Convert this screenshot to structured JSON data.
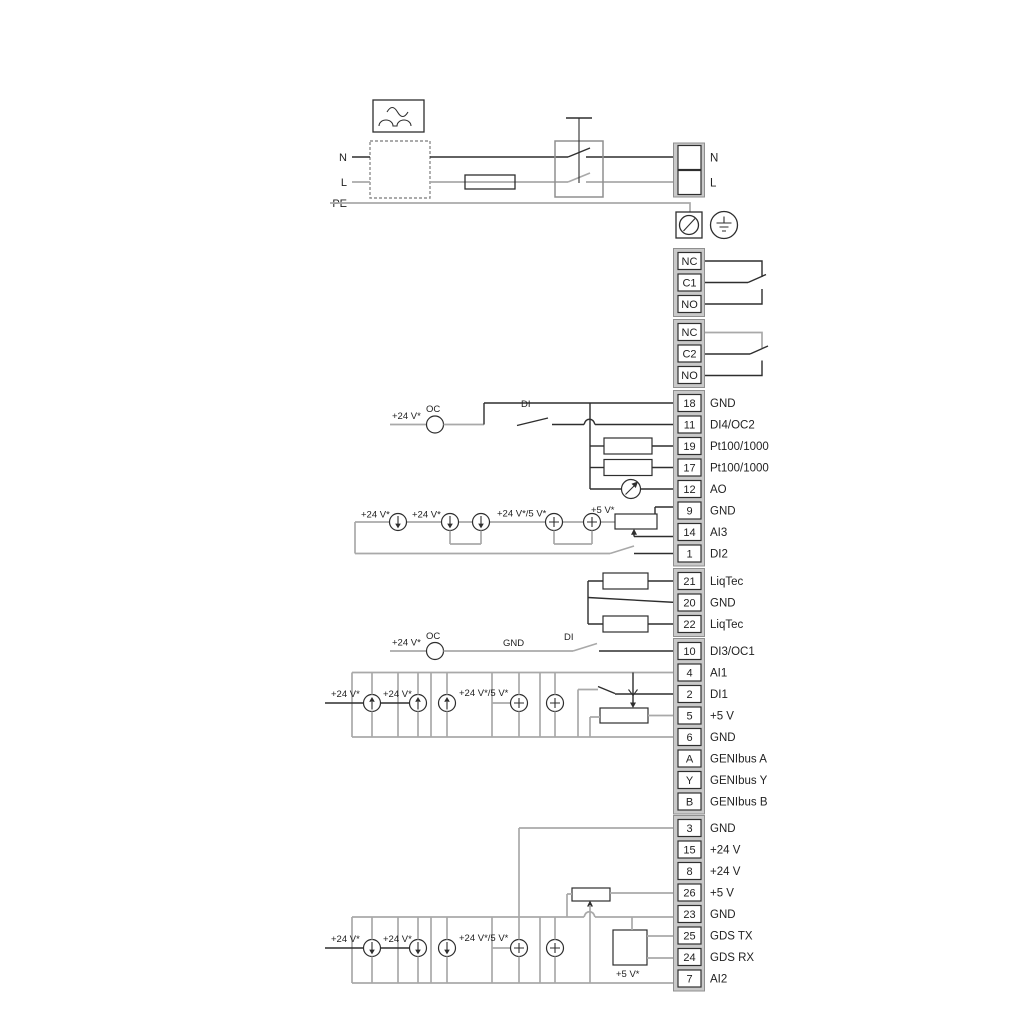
{
  "labels": {
    "n": "N",
    "l": "L",
    "pe": "PE",
    "v24": "+24 V*",
    "v24_5": "+24 V*/5 V*",
    "v5": "+5 V*",
    "oc": "OC",
    "di": "DI",
    "gnd": "GND"
  },
  "mains_block": {
    "n": "N",
    "l": "L"
  },
  "terminal_blocks": [
    {
      "name": "relay-1",
      "terminals": [
        {
          "id": "NC",
          "label": ""
        },
        {
          "id": "C1",
          "label": ""
        },
        {
          "id": "NO",
          "label": ""
        }
      ]
    },
    {
      "name": "relay-2",
      "terminals": [
        {
          "id": "NC",
          "label": ""
        },
        {
          "id": "C2",
          "label": ""
        },
        {
          "id": "NO",
          "label": ""
        }
      ]
    },
    {
      "name": "io-block-1",
      "terminals": [
        {
          "id": "18",
          "label": "GND"
        },
        {
          "id": "11",
          "label": "DI4/OC2"
        },
        {
          "id": "19",
          "label": "Pt100/1000"
        },
        {
          "id": "17",
          "label": "Pt100/1000"
        },
        {
          "id": "12",
          "label": "AO"
        },
        {
          "id": "9",
          "label": "GND"
        },
        {
          "id": "14",
          "label": "AI3"
        },
        {
          "id": "1",
          "label": "DI2"
        }
      ]
    },
    {
      "name": "liqtec-block",
      "terminals": [
        {
          "id": "21",
          "label": "LiqTec"
        },
        {
          "id": "20",
          "label": "GND"
        },
        {
          "id": "22",
          "label": "LiqTec"
        }
      ]
    },
    {
      "name": "io-block-2",
      "terminals": [
        {
          "id": "10",
          "label": "DI3/OC1"
        },
        {
          "id": "4",
          "label": "AI1"
        },
        {
          "id": "2",
          "label": "DI1"
        },
        {
          "id": "5",
          "label": "+5 V"
        },
        {
          "id": "6",
          "label": "GND"
        },
        {
          "id": "A",
          "label": "GENIbus A"
        },
        {
          "id": "Y",
          "label": "GENIbus Y"
        },
        {
          "id": "B",
          "label": "GENIbus B"
        }
      ]
    },
    {
      "name": "io-block-3",
      "terminals": [
        {
          "id": "3",
          "label": "GND"
        },
        {
          "id": "15",
          "label": "+24 V"
        },
        {
          "id": "8",
          "label": "+24 V"
        },
        {
          "id": "26",
          "label": "+5 V"
        },
        {
          "id": "23",
          "label": "GND"
        },
        {
          "id": "25",
          "label": "GDS TX"
        },
        {
          "id": "24",
          "label": "GDS RX"
        },
        {
          "id": "7",
          "label": "AI2"
        }
      ]
    }
  ]
}
